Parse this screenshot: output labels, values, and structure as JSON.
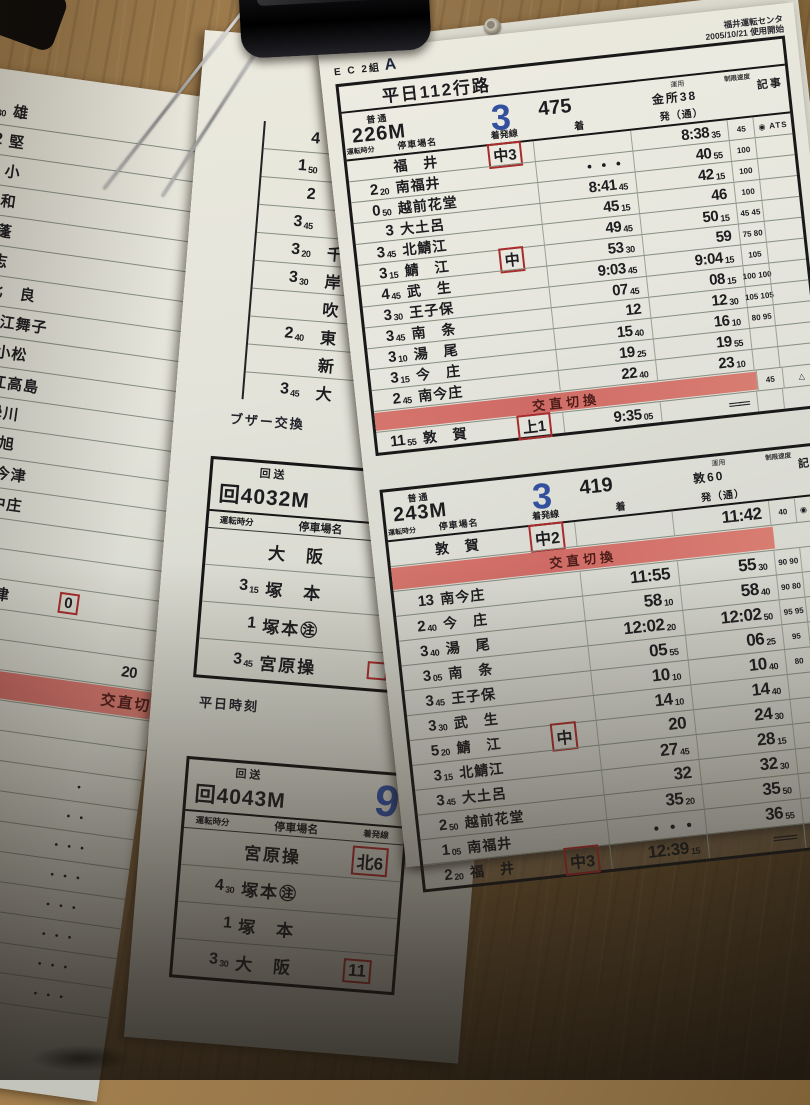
{
  "accent_colors": {
    "handwriting_blue": "#33509e",
    "stamp_red": "#a82c2c",
    "band_red": "#d5756c",
    "paper": "#e3e3da",
    "wood": "#82643a"
  },
  "main": {
    "corner": {
      "left": "E C  2組",
      "mark": "A",
      "depot": "福井運転センタ",
      "date": "2005/10/21",
      "date_note": "使用開始"
    },
    "col_labels": {
      "time": "運転時分",
      "station": "停車場名",
      "track": "着発線",
      "arr": "着",
      "dep": "発（通）",
      "speed": "制限速度",
      "note": "記事"
    },
    "t1": {
      "title": "平日112行路",
      "type": "普通",
      "no": "226M",
      "seq": "3",
      "num": "475",
      "unyo_label": "運用",
      "unyo": "金所38",
      "rows": [
        {
          "s": "福　井",
          "box": "中3",
          "d": "8:38|35",
          "v": "45",
          "n": "◉ ATS"
        },
        {
          "t": "2|20",
          "s": "南福井",
          "a": "・・・",
          "d": "40|55",
          "v": "100"
        },
        {
          "t": "0|50",
          "s": "越前花堂",
          "a": "8:41|45",
          "d": "42|15",
          "v": "100"
        },
        {
          "t": "3",
          "s": "大土呂",
          "a": "45|15",
          "d": "46",
          "v": "100"
        },
        {
          "t": "3|45",
          "s": "北鯖江",
          "a": "49|45",
          "d": "50|15",
          "v": "45 45"
        },
        {
          "t": "3|15",
          "s": "鯖　江",
          "box": "中",
          "a": "53|30",
          "d": "59",
          "v": "75 80"
        },
        {
          "t": "4|45",
          "s": "武　生",
          "a": "9:03|45",
          "d": "9:04|15",
          "v": "105"
        },
        {
          "t": "3|30",
          "s": "王子保",
          "a": "07|45",
          "d": "08|15",
          "v": "100 100"
        },
        {
          "t": "3|45",
          "s": "南　条",
          "a": "12",
          "d": "12|30",
          "v": "105 105"
        },
        {
          "t": "3|10",
          "s": "湯　尾",
          "a": "15|40",
          "d": "16|10",
          "v": "80 95"
        },
        {
          "t": "3|15",
          "s": "今　庄",
          "a": "19|25",
          "d": "19|55"
        },
        {
          "t": "2|45",
          "s": "南今庄",
          "a": "22|40",
          "d": "23|10"
        },
        {
          "bar": "交直切換",
          "v": "45",
          "n": "△"
        },
        {
          "t": "11|55",
          "s": "敦　賀",
          "box": "上1",
          "a": "9:35|05",
          "d": "══"
        }
      ]
    },
    "t2": {
      "type": "普通",
      "no": "243M",
      "seq": "3",
      "num": "419",
      "unyo_label": "運用",
      "unyo": "敦60",
      "rows": [
        {
          "s": "敦　賀",
          "box": "中2",
          "d": "11:42",
          "v": "40",
          "n": "◉ ATS"
        },
        {
          "bar": "交直切換"
        },
        {
          "t": "13",
          "s": "南今庄",
          "a": "11:55",
          "d": "55|30",
          "v": "90 90"
        },
        {
          "t": "2|40",
          "s": "今　庄",
          "a": "58|10",
          "d": "58|40",
          "v": "90 80"
        },
        {
          "t": "3|40",
          "s": "湯　尾",
          "a": "12:02|20",
          "d": "12:02|50",
          "v": "95 95"
        },
        {
          "t": "3|05",
          "s": "南　条",
          "a": "05|55",
          "d": "06|25",
          "v": "95"
        },
        {
          "t": "3|45",
          "s": "王子保",
          "a": "10|10",
          "d": "10|40",
          "v": "80"
        },
        {
          "t": "3|30",
          "s": "武　生",
          "a": "14|10",
          "d": "14|40"
        },
        {
          "t": "5|20",
          "s": "鯖　江",
          "box": "中",
          "a": "20",
          "d": "24|30"
        },
        {
          "t": "3|15",
          "s": "北鯖江",
          "a": "27|45",
          "d": "28|15"
        },
        {
          "t": "3|45",
          "s": "大土呂",
          "a": "32",
          "d": "32|30"
        },
        {
          "t": "2|50",
          "s": "越前花堂",
          "a": "35|20",
          "d": "35|50"
        },
        {
          "t": "1|05",
          "s": "南福井",
          "a": "・・・",
          "d": "36|55"
        },
        {
          "t": "2|20",
          "s": "福　井",
          "box": "中3",
          "a": "12:39|15",
          "d": "══"
        }
      ]
    }
  },
  "left_card": {
    "rows": [
      {
        "t": "5|30",
        "s": "雄"
      },
      {
        "t": "2",
        "s": "堅"
      },
      {
        "s": "小"
      },
      {
        "s": "和"
      },
      {
        "t": "7|20",
        "s": "蓬"
      },
      {
        "s": "志"
      },
      {
        "s": "比　良"
      },
      {
        "s": "近江舞子"
      },
      {
        "t": "6",
        "s": "北小松"
      },
      {
        "s": "近江高島"
      },
      {
        "s": "安曇川"
      },
      {
        "t": "4|05",
        "s": "新　旭"
      },
      {
        "s": "近江今津"
      },
      {
        "t": "3|45",
        "s": "近江中庄"
      },
      {
        "t": "3|20",
        "s": "マキノ"
      },
      {
        "t": "2|50",
        "s": "永　原"
      },
      {
        "t": "4|40",
        "s": "近江塩津",
        "box": "0"
      },
      {
        "t": "4|55",
        "s": "新疋田"
      },
      {
        "s": "敦　賀",
        "d": "20"
      },
      {
        "bar": "交直切換"
      },
      {
        "t": "10|45",
        "s": "南今庄"
      },
      {
        "s": "今　庄"
      },
      {
        "s": "湯　尾",
        "a": "・"
      },
      {
        "s": "南　条",
        "a": "・・"
      },
      {
        "s": "子保",
        "a": "・・・"
      },
      {
        "s": "生",
        "a": "・・・"
      },
      {
        "s": "江",
        "a": "・・・"
      },
      {
        "a": "・・・"
      },
      {
        "a": "・・・"
      },
      {
        "a": "・・・"
      },
      {
        "big": "20:34|30"
      }
    ]
  },
  "middle_card": {
    "strip_rows": [
      {
        "t": "4"
      },
      {
        "t": "1|50"
      },
      {
        "t": "2"
      },
      {
        "t": "3|45"
      },
      {
        "t": "3|20",
        "s": "千"
      },
      {
        "t": "3|30",
        "s": "岸"
      },
      {
        "s": "吹"
      },
      {
        "t": "2|40",
        "s": "東"
      },
      {
        "s": "新"
      },
      {
        "t": "3|45",
        "s": "大"
      }
    ],
    "buzzer_note": "ブザー交換",
    "weekday_note": "平日時刻",
    "d1": {
      "type_label": "回送",
      "no": "回4032M",
      "rows": [
        {
          "s": "大　阪"
        },
        {
          "t": "3|15",
          "s": "塚　本"
        },
        {
          "t": "1",
          "s": "塚本㊟"
        },
        {
          "t": "3|45",
          "s": "宮原操",
          "box": ""
        }
      ]
    },
    "d2": {
      "type_label": "回送",
      "no": "回4043M",
      "run_no": "9",
      "rows": [
        {
          "s": "宮原操",
          "box": "北6"
        },
        {
          "t": "4|30",
          "s": "塚本㊟"
        },
        {
          "t": "1",
          "s": "塚　本"
        },
        {
          "t": "3|30",
          "s": "大　阪",
          "box": "11"
        }
      ]
    }
  }
}
